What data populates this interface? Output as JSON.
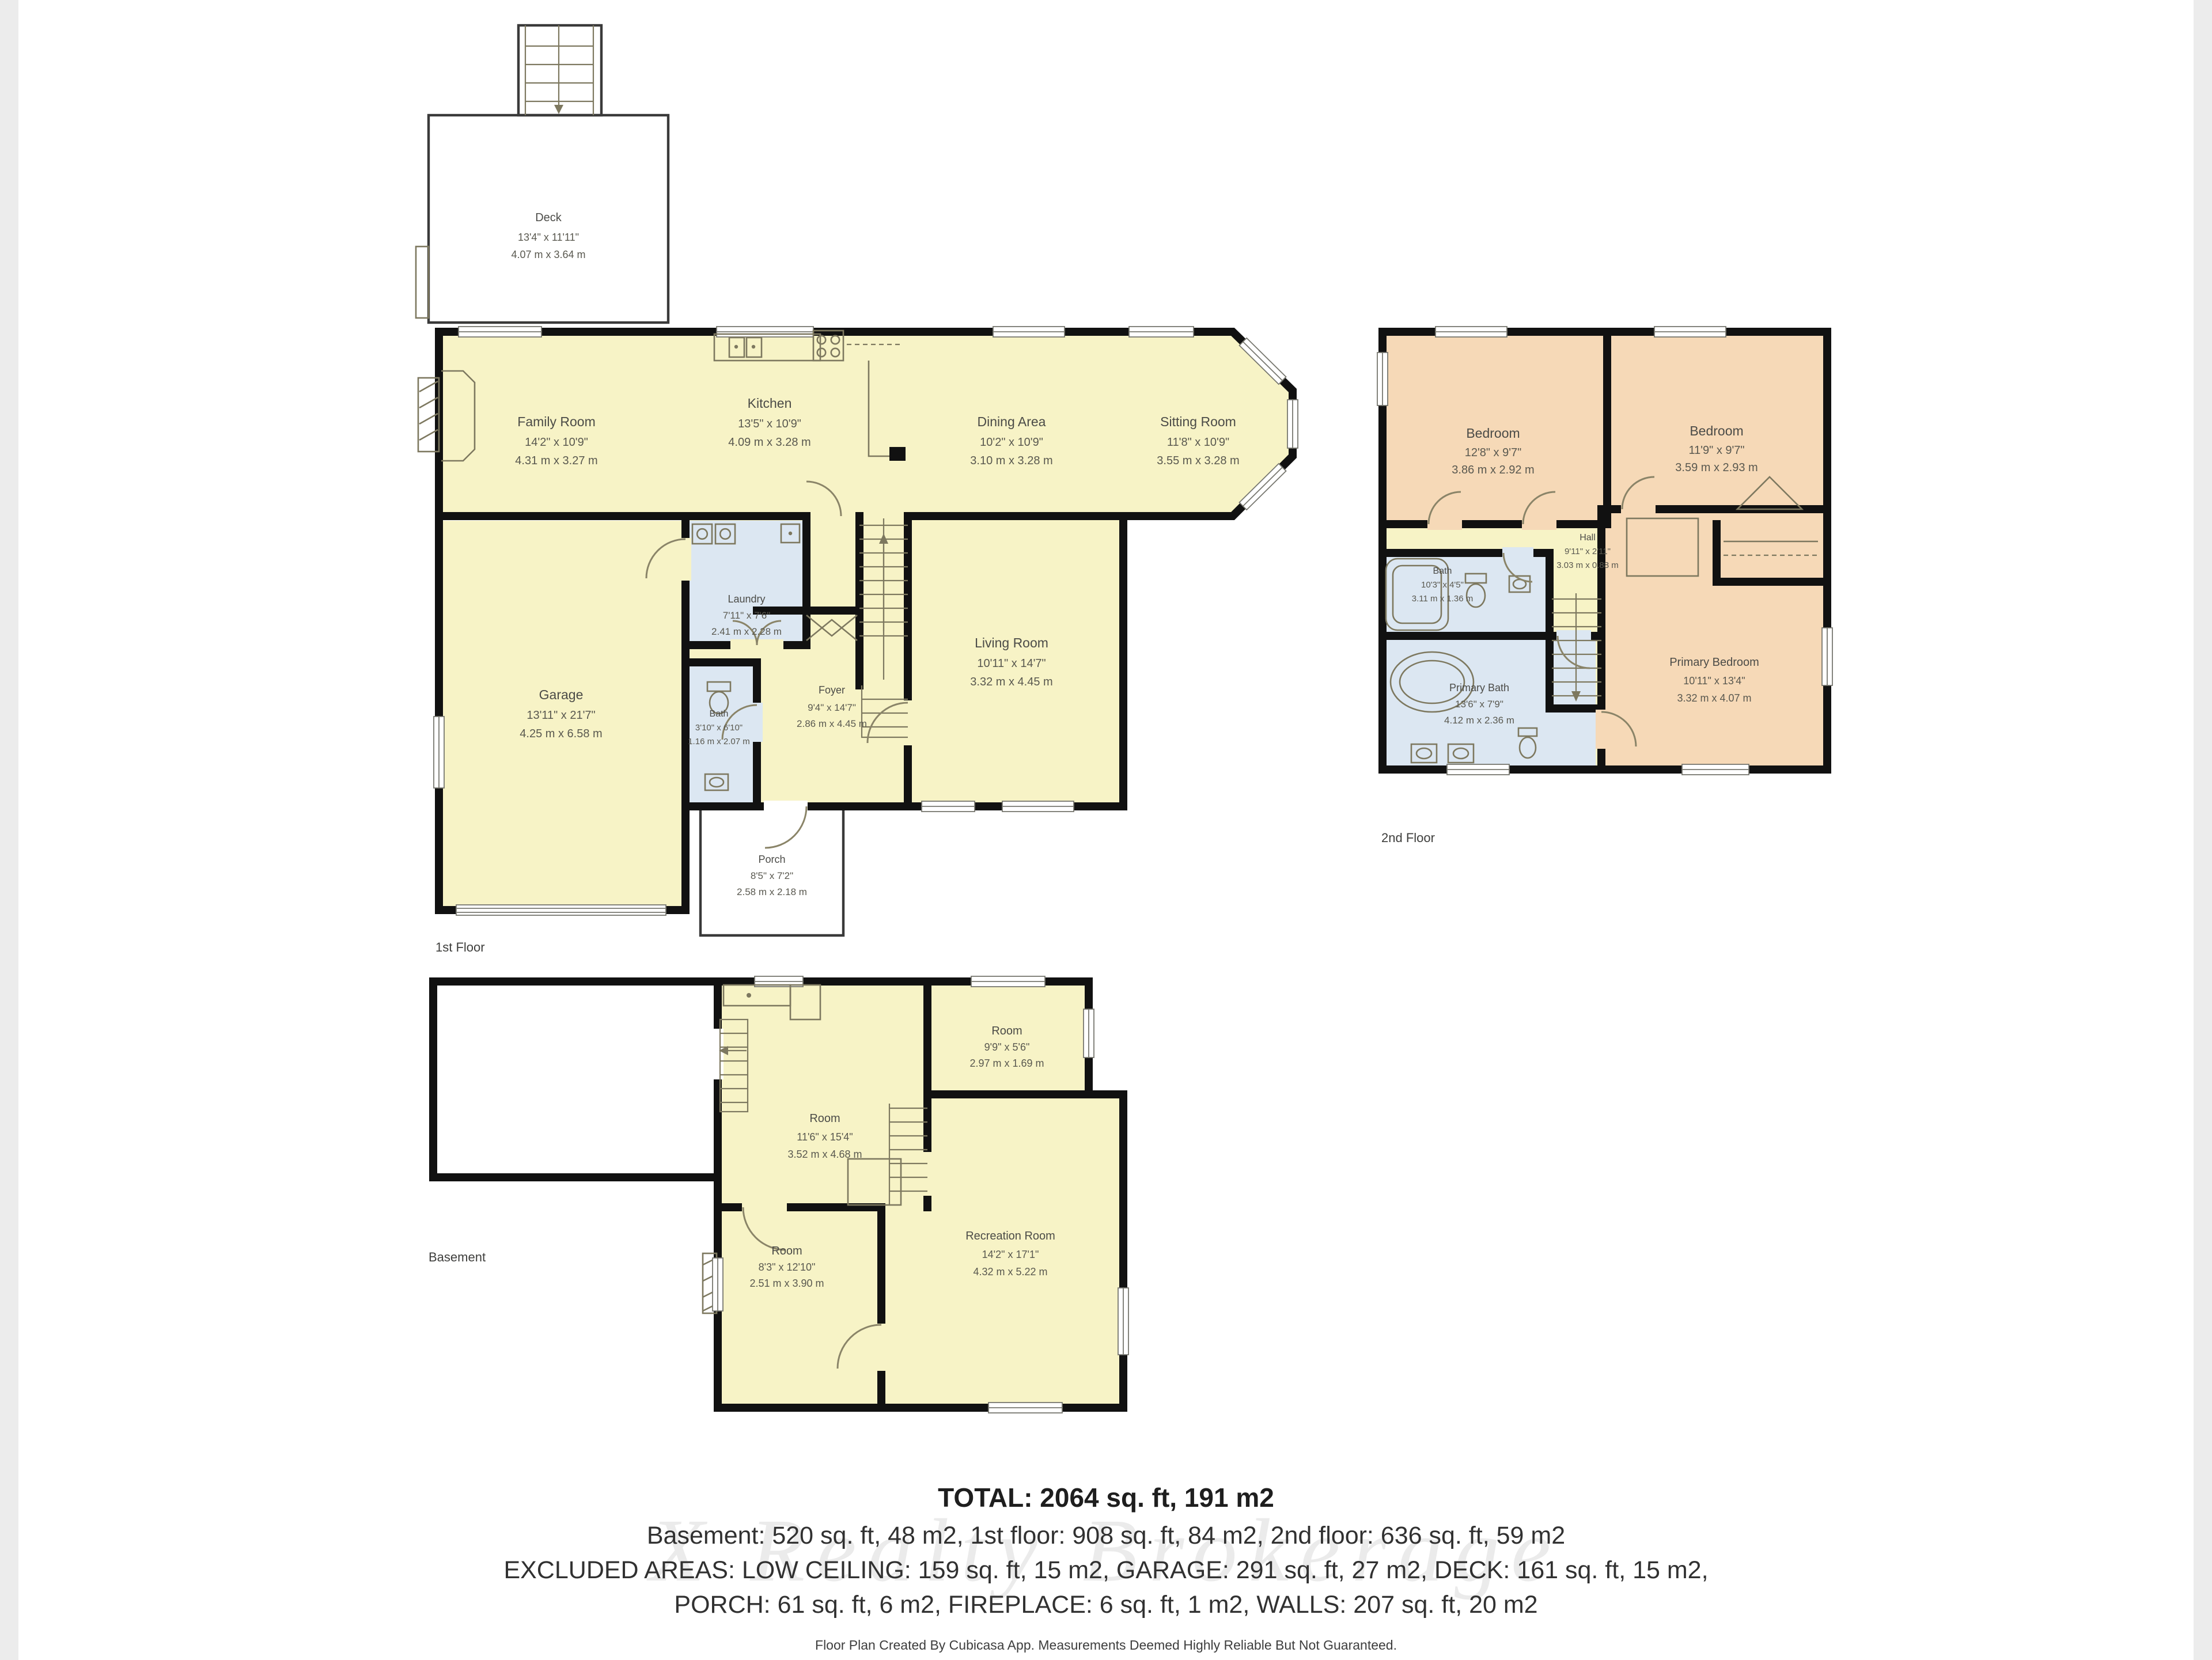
{
  "colors": {
    "room_yellow": "#F7F3C6",
    "room_peach": "#F6D9B7",
    "room_blue": "#DCE7F2",
    "wall_black": "#111111",
    "edge_gray": "#ECECEC"
  },
  "floors": {
    "first": {
      "label": "1st Floor",
      "rooms": {
        "deck": {
          "name": "Deck",
          "imperial": "13'4\" x 11'11\"",
          "metric": "4.07 m x 3.64 m"
        },
        "family_room": {
          "name": "Family Room",
          "imperial": "14'2\" x 10'9\"",
          "metric": "4.31 m x 3.27 m"
        },
        "kitchen": {
          "name": "Kitchen",
          "imperial": "13'5\" x 10'9\"",
          "metric": "4.09 m x 3.28 m"
        },
        "dining_area": {
          "name": "Dining Area",
          "imperial": "10'2\" x 10'9\"",
          "metric": "3.10 m x 3.28 m"
        },
        "sitting_room": {
          "name": "Sitting Room",
          "imperial": "11'8\" x 10'9\"",
          "metric": "3.55 m x 3.28 m"
        },
        "laundry": {
          "name": "Laundry",
          "imperial": "7'11\" x 7'6\"",
          "metric": "2.41 m x 2.28 m"
        },
        "bath": {
          "name": "Bath",
          "imperial": "3'10\" x 6'10\"",
          "metric": "1.16 m x 2.07 m"
        },
        "foyer": {
          "name": "Foyer",
          "imperial": "9'4\" x 14'7\"",
          "metric": "2.86 m x 4.45 m"
        },
        "living_room": {
          "name": "Living Room",
          "imperial": "10'11\" x 14'7\"",
          "metric": "3.32 m x 4.45 m"
        },
        "garage": {
          "name": "Garage",
          "imperial": "13'11\" x 21'7\"",
          "metric": "4.25 m x 6.58 m"
        },
        "porch": {
          "name": "Porch",
          "imperial": "8'5\" x 7'2\"",
          "metric": "2.58 m x 2.18 m"
        }
      }
    },
    "second": {
      "label": "2nd Floor",
      "rooms": {
        "bedroom_left": {
          "name": "Bedroom",
          "imperial": "12'8\" x 9'7\"",
          "metric": "3.86 m x 2.92 m"
        },
        "bedroom_right": {
          "name": "Bedroom",
          "imperial": "11'9\" x 9'7\"",
          "metric": "3.59 m x 2.93 m"
        },
        "hall": {
          "name": "Hall",
          "imperial": "9'11\" x 2'11\"",
          "metric": "3.03 m x 0.88 m"
        },
        "bath": {
          "name": "Bath",
          "imperial": "10'3\" x 4'5\"",
          "metric": "3.11 m x 1.36 m"
        },
        "primary_bath": {
          "name": "Primary Bath",
          "imperial": "13'6\" x 7'9\"",
          "metric": "4.12 m x 2.36 m"
        },
        "primary_bedroom": {
          "name": "Primary Bedroom",
          "imperial": "10'11\" x 13'4\"",
          "metric": "3.32 m x 4.07 m"
        }
      }
    },
    "basement": {
      "label": "Basement",
      "rooms": {
        "room_main": {
          "name": "Room",
          "imperial": "11'6\" x 15'4\"",
          "metric": "3.52 m x 4.68 m"
        },
        "room_upper": {
          "name": "Room",
          "imperial": "9'9\" x 5'6\"",
          "metric": "2.97 m x 1.69 m"
        },
        "room_lower": {
          "name": "Room",
          "imperial": "8'3\" x 12'10\"",
          "metric": "2.51 m x 3.90 m"
        },
        "recreation_room": {
          "name": "Recreation Room",
          "imperial": "14'2\" x 17'1\"",
          "metric": "4.32 m x 5.22 m"
        }
      }
    }
  },
  "summary": {
    "total": "TOTAL: 2064 sq. ft, 191 m2",
    "line1": "Basement: 520 sq. ft, 48 m2, 1st floor: 908 sq. ft, 84 m2, 2nd floor: 636 sq. ft, 59 m2",
    "line2": "EXCLUDED AREAS: LOW CEILING: 159 sq. ft, 15 m2, GARAGE: 291 sq. ft, 27 m2, DECK: 161 sq. ft, 15 m2,",
    "line3": "PORCH: 61 sq. ft, 6 m2, FIREPLACE: 6 sq. ft, 1 m2, WALLS: 207 sq. ft, 20 m2",
    "watermark": "X Realty Brokerage",
    "footer": "Floor Plan Created By Cubicasa App. Measurements Deemed Highly Reliable But Not Guaranteed."
  }
}
